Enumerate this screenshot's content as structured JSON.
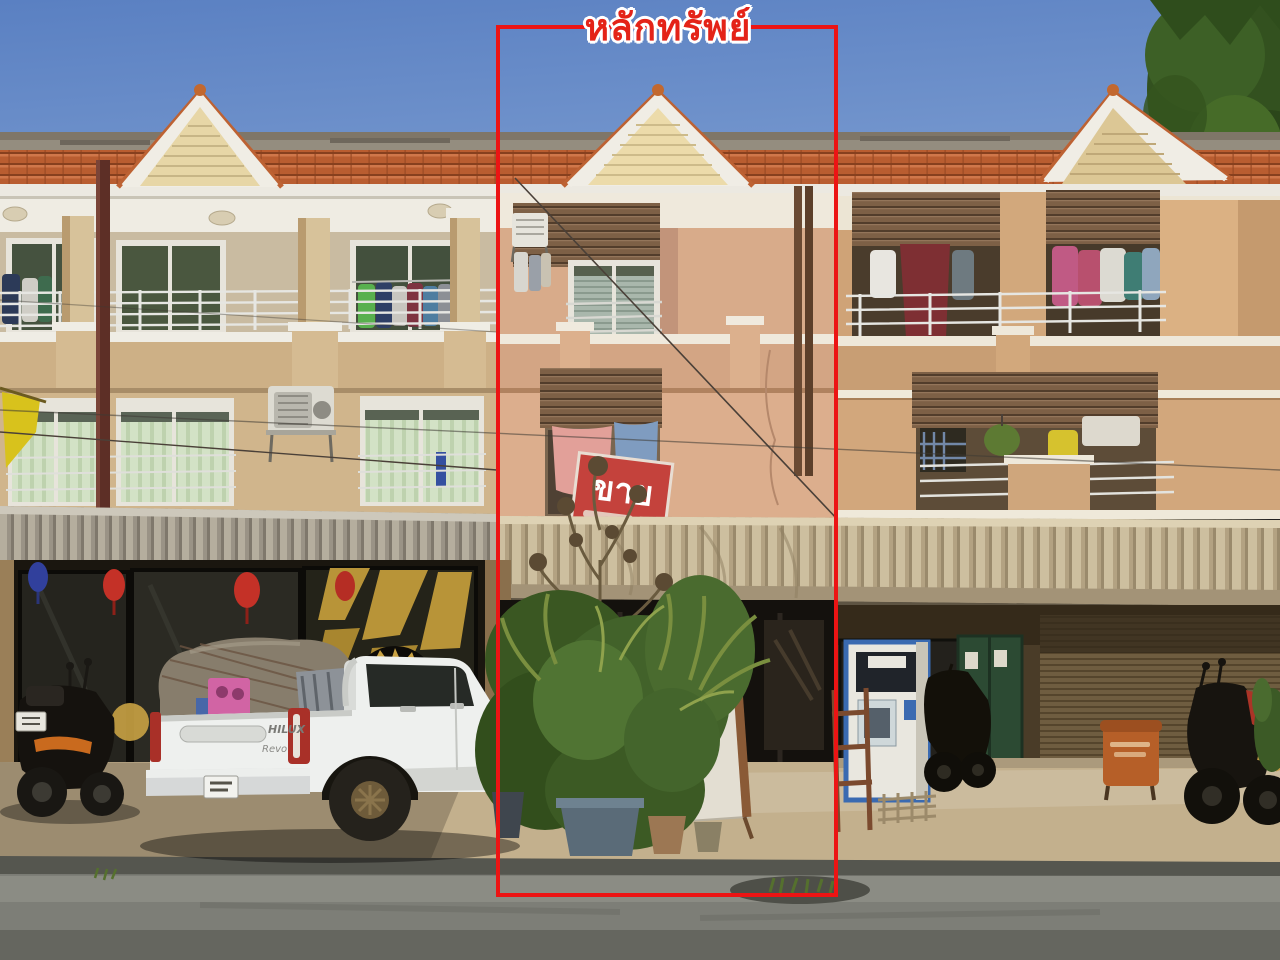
{
  "annotation": {
    "label": "หลักทรัพย์",
    "label_color": "#e42318",
    "box_color": "#ec1414"
  },
  "listing": {
    "sale_banner": "ขาย",
    "sale_banner_color": "#c4423c"
  },
  "vehicles": {
    "pickup_badge_model": "HILUX",
    "pickup_badge_trim": "Revo"
  },
  "palette": {
    "sky_top": "#5a80c2",
    "sky_bottom": "#8fadd9",
    "roof_tile": "#b95d30",
    "gable_siding": "#e7d6a6",
    "wall_left_building": "#d0b58c",
    "wall_highlighted_unit": "#d8ab8a",
    "wall_right_building": "#cfa377",
    "shutter_brown": "#7d6046",
    "awning_main": "#cdbf9f",
    "awning_left": "#b5ae9e",
    "shopfront_dark": "#1a160f",
    "sidewalk": "#c3b08d",
    "road": "#7d7e77",
    "foliage": "#47662c",
    "truck_white": "#eef0ee"
  }
}
